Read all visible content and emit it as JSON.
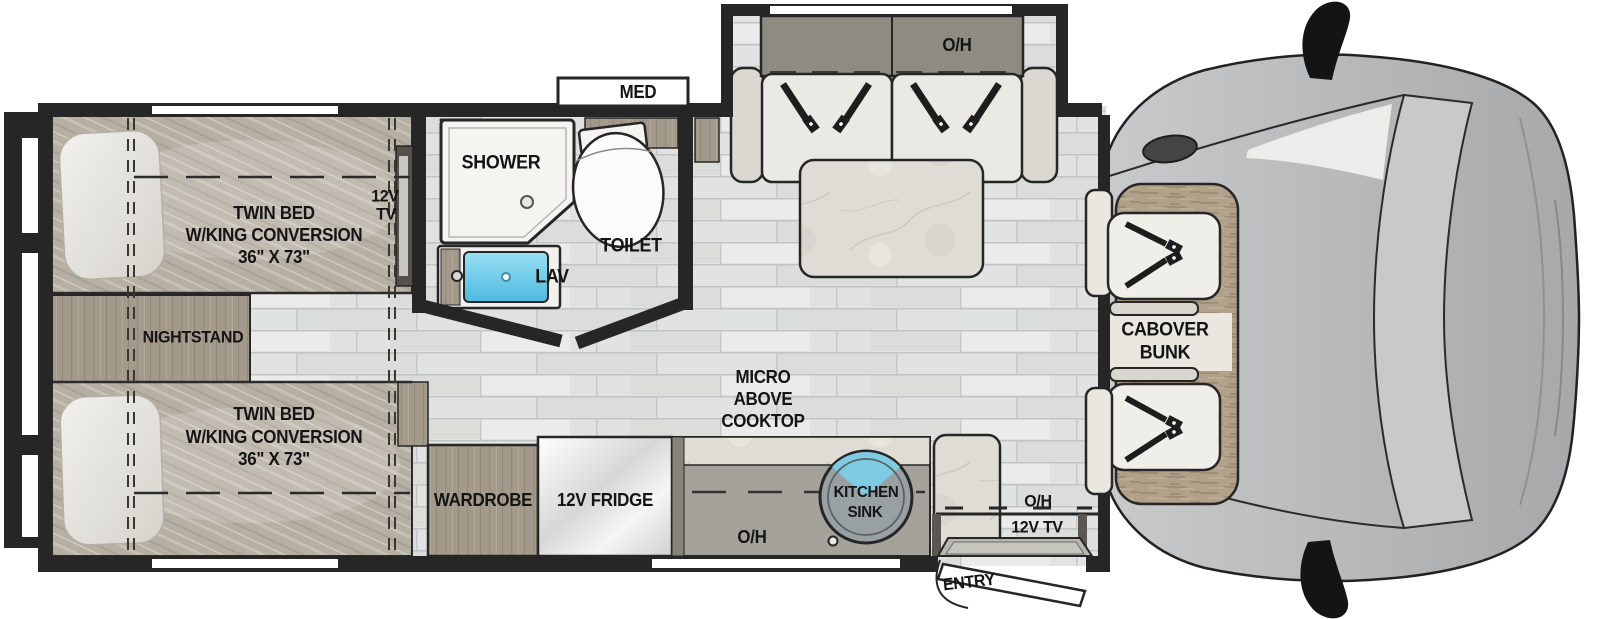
{
  "plan": {
    "bedroom": {
      "bed1": {
        "l1": "TWIN BED",
        "l2": "W/KING CONVERSION",
        "l3": "36\" X 73\""
      },
      "bed2": {
        "l1": "TWIN BED",
        "l2": "W/KING CONVERSION",
        "l3": "36\" X 73\""
      },
      "nightstand": "NIGHTSTAND",
      "tv_l1": "12V",
      "tv_l2": "TV"
    },
    "bathroom": {
      "med": "MED",
      "shower": "SHOWER",
      "toilet": "TOILET",
      "lav": "LAV"
    },
    "living": {
      "sofa_oh": "O/H"
    },
    "kitchen": {
      "micro_l1": "MICRO",
      "micro_l2": "ABOVE",
      "micro_l3": "COOKTOP",
      "sink_l1": "KITCHEN",
      "sink_l2": "SINK",
      "counter_oh": "O/H",
      "wardrobe": "WARDROBE",
      "fridge": "12V FRIDGE"
    },
    "entry": {
      "oh": "O/H",
      "tv": "12V TV",
      "entry": "ENTRY"
    },
    "cab": {
      "bunk_l1": "CABOVER",
      "bunk_l2": "BUNK"
    }
  },
  "colors": {
    "wall": "#262626",
    "floor_plank": "#e1e3e2",
    "bed_fabric": "#b6afa4",
    "wood": "#a39a8c",
    "marble": "#dfdcd5",
    "lav_blue": "#6ec9e4",
    "cab_body": "#b9bbbd",
    "bunk_tan": "#b2a18a"
  }
}
